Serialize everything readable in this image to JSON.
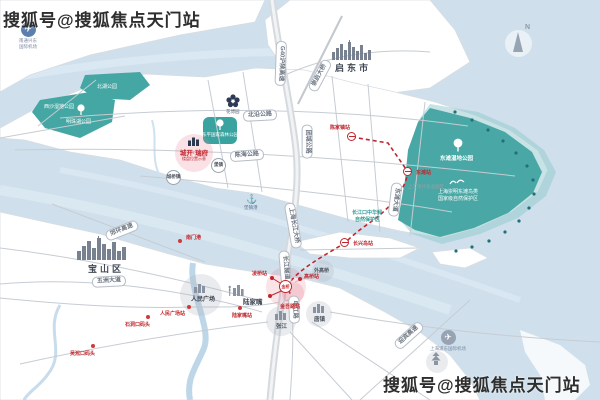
{
  "watermarks": {
    "top": "搜狐号@搜狐焦点天门站",
    "bottom": "搜狐号@搜狐焦点天门站"
  },
  "compass_label": "N",
  "cities": {
    "qidong": "启东市",
    "baoshan": "宝山区"
  },
  "airports": {
    "northwest_line1": "南通兴东",
    "northwest_line2": "国际机场",
    "southeast": "上海浦东国际机场"
  },
  "parks": {
    "north_lake": "北湖公园",
    "xisha": "西沙湿地公园",
    "mingzhu_lake": "明珠湖公园",
    "dongping": "东平国家森林公园",
    "expo": "花博园",
    "dongtan_wetland": "东滩湿地公园",
    "bird_reserve_line1": "上海崇明东滩鸟类",
    "bird_reserve_line2": "国家级自然保护区",
    "sturgeon_line1": "长江口中华鲟",
    "sturgeon_line2": "自然保护区"
  },
  "roads": {
    "beiyan": "北沿公路",
    "chenhai": "陈海公路",
    "tuancheng": "团城公路",
    "dongtan_ave": "东滩大道",
    "g40": "G40沪陕高速",
    "chongqi_bridge": "崇启大桥",
    "changjiang_bridge": "上海长江大桥",
    "changjiang_tunnel": "长江隧道",
    "wuzhou_ave": "五洲大道",
    "jiaohuan": "郊环高速",
    "yingbin": "迎宾高速",
    "shenjiang": "申江路"
  },
  "metro": {
    "stations": {
      "chenjiazhen": "陈家镇站",
      "dongtan": "东滩站",
      "changxingdao": "长兴岛站",
      "lingqiao": "凌桥站",
      "gaoqiao": "高桥站",
      "jinwulu": "金吾路站"
    },
    "jinqiao_badge": "金桥"
  },
  "towns": {
    "baozhen": "堡镇",
    "chengqiao": "城桥镇"
  },
  "port": {
    "baozhen_port": "堡镇港"
  },
  "ferries": {
    "nanmen": "南门港",
    "shidongkou": "石洞口码头",
    "wusongkou": "吴淞口码头"
  },
  "landmarks": {
    "renmin_square": "人民广场",
    "renmin_station": "人民广场站",
    "lujiazui": "陆家嘴",
    "lujiazui_station": "陆家嘴站",
    "waigaoqiao": "外高桥",
    "zhangjiang": "张江",
    "tangzhen": "唐镇"
  },
  "zones": {
    "agri_park": "上实现代农业园区"
  },
  "project": {
    "name": "城开·瑞府",
    "note": "楼盘位置示意"
  },
  "colors": {
    "water": "#cfe0ec",
    "land": "#ffffff",
    "park_teal": "#45a7a3",
    "metro_red": "#c0272d",
    "road_gray": "#c6ccd3"
  }
}
